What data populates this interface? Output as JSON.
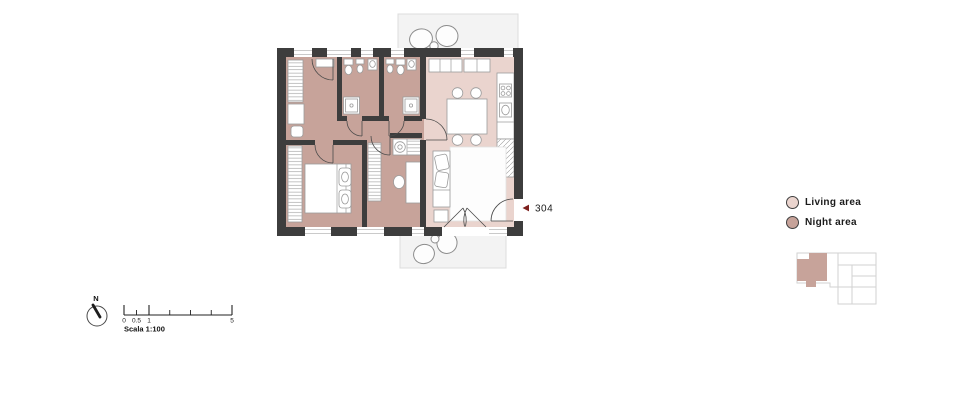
{
  "plan": {
    "unit_marker": {
      "number": "304"
    },
    "areas": [
      {
        "name": "Living area"
      },
      {
        "name": "Night area"
      }
    ]
  },
  "legend": {
    "items": [
      {
        "label": "Living area",
        "swatch": "living_area"
      },
      {
        "label": "Night area",
        "swatch": "night_area"
      }
    ]
  },
  "compass": {
    "label": "N"
  },
  "scalebar": {
    "labels": [
      "0",
      "0.5",
      "1",
      "5"
    ],
    "caption": "Scala 1:100"
  },
  "colors": {
    "wall": "#3d3d3d",
    "night_area": "#c7a39a",
    "living_area": "#ead4ce",
    "balcony_fill": "#f3f3f3",
    "balcony_stroke": "#dcdcdc",
    "furniture_stroke": "#9b9b9b",
    "marker_red": "#7d201d",
    "keyplan_outline": "#d2d2d2",
    "text": "#1b1b1b"
  }
}
